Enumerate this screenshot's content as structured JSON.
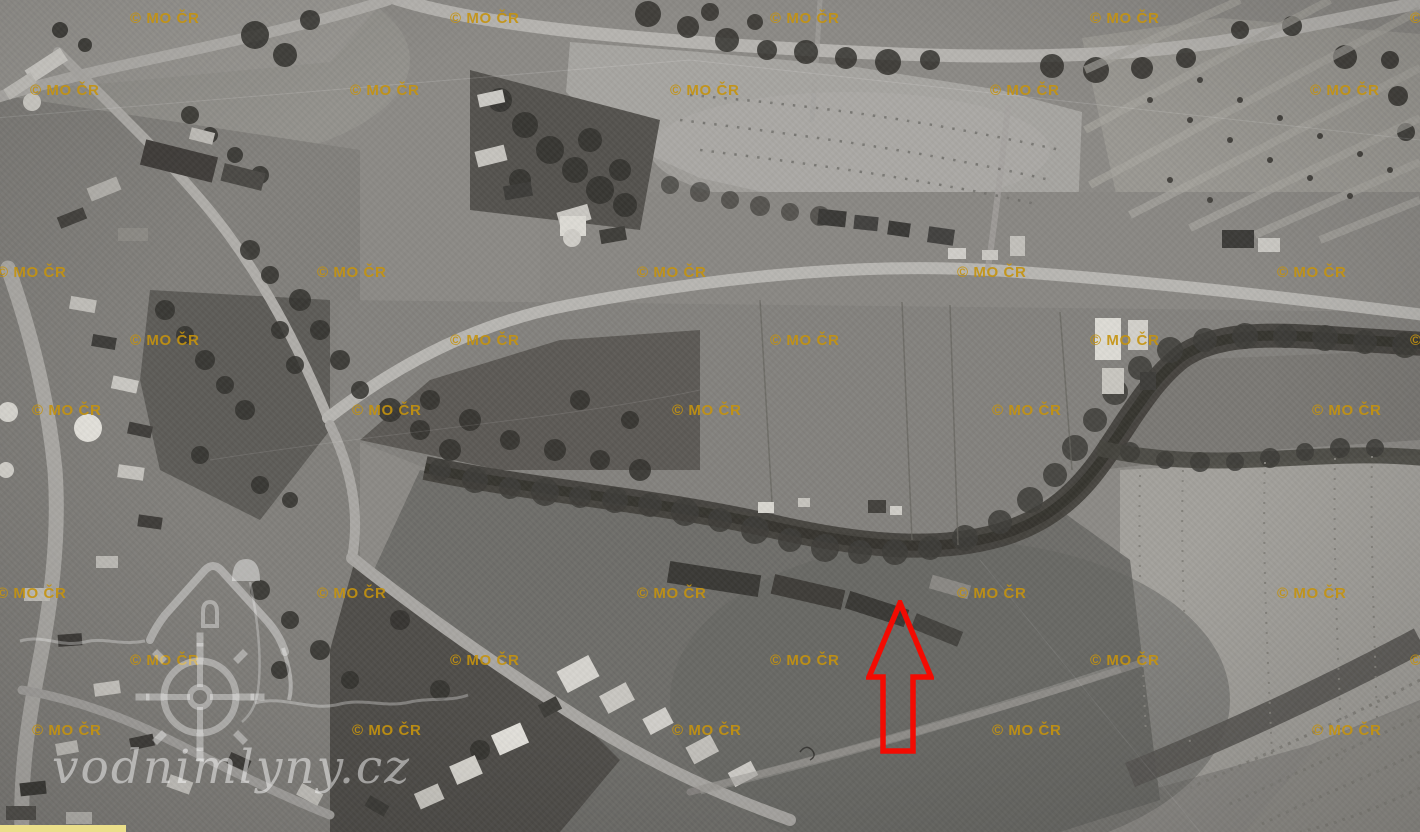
{
  "page": {
    "width": 1420,
    "height": 832,
    "alt": "Historical black-and-white aerial photograph of a village with roads, a tree-lined stream, orchards and fields"
  },
  "copyright_watermark": {
    "text": "© MO ČR",
    "count": 40
  },
  "brand_watermark": {
    "text": "vodnimlyny.cz",
    "icon": "watermill-house-icon"
  },
  "annotation": {
    "shape": "up-arrow-outline",
    "direction": "up"
  },
  "partial_ui": {
    "shape": "horizontal-bar"
  },
  "colors": {
    "watermark_gold": "#C5930E",
    "arrow_red": "#F30B02",
    "brand_white": "rgba(255,255,255,0.48)",
    "partial_yellow": "#EBDF8A",
    "photo_base": "#8C8A86"
  }
}
